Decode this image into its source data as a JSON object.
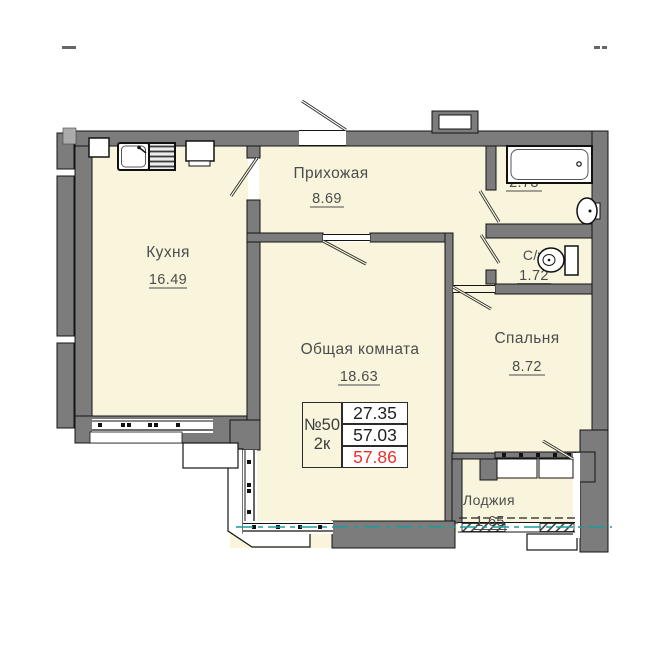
{
  "plan": {
    "title": "2-room apartment floor plan",
    "rooms": [
      {
        "name": "Кухня",
        "area": "16.49"
      },
      {
        "name": "Прихожая",
        "area": "8.69"
      },
      {
        "name": "С/у",
        "area": "2.78"
      },
      {
        "name": "С/у",
        "area": "1.72"
      },
      {
        "name": "Спальня",
        "area": "8.72"
      },
      {
        "name": "Общая комната",
        "area": "18.63"
      },
      {
        "name": "Лоджия",
        "area": "1.65"
      }
    ],
    "info_table": {
      "number": "№50",
      "rooms_count": "2к",
      "living_area": "27.35",
      "area_without_loggia": "57.03",
      "total_area": "57.86"
    },
    "colors": {
      "floor_fill": "#f8f5dc",
      "wall_gray": "#7c7c7c",
      "outline": "#141414",
      "section_line_teal": "#1f9c9c",
      "total_area_red": "#e8312a",
      "label_gray": "#4c4c4c"
    }
  }
}
